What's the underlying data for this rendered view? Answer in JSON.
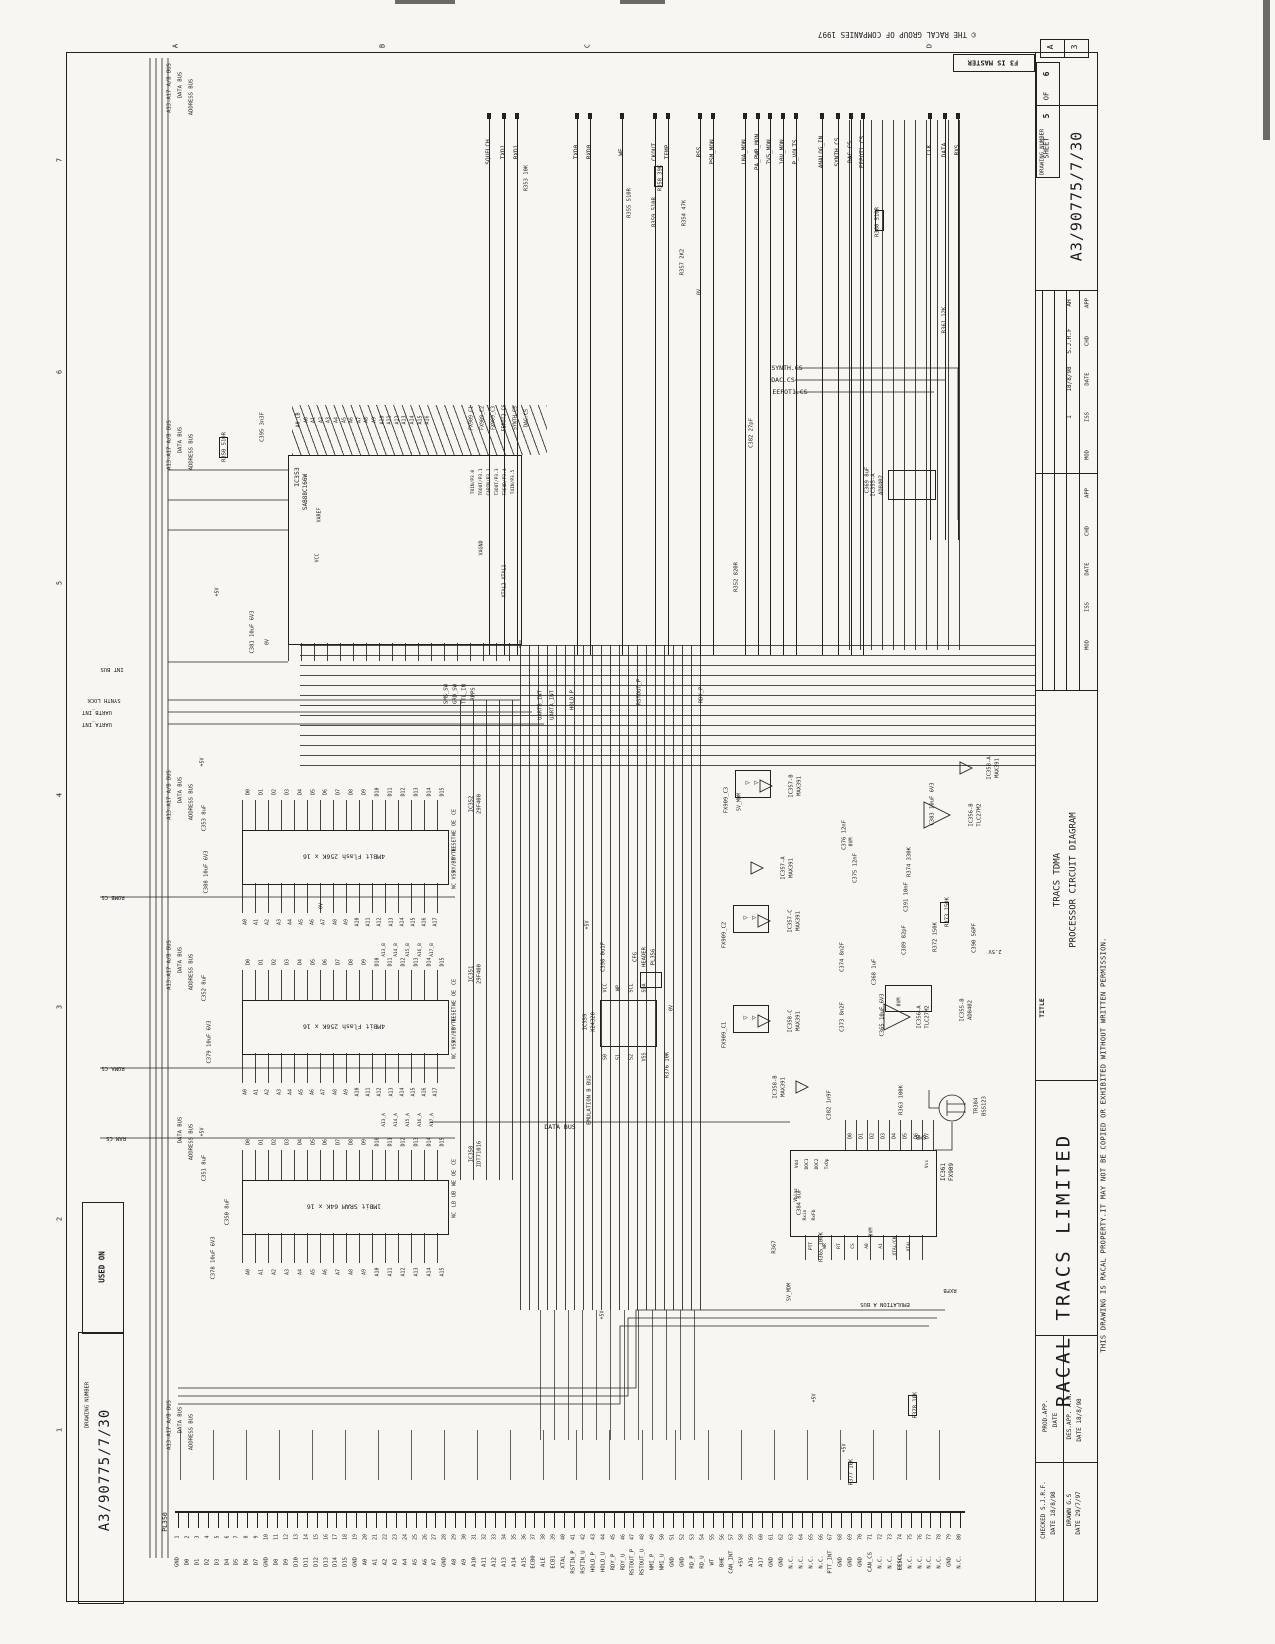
{
  "sheet": {
    "copyright": "© THE RACAL GROUP OF COMPANIES 1997",
    "master_note": "F3 IS MASTER",
    "size_a": "A",
    "size_3": "3",
    "sheet_label": "SHEET",
    "sheet_no": "5",
    "of_label": "OF",
    "sheet_total": "6",
    "drawing_number_label": "DRAWING NUMBER",
    "drawing_number": "A3/90775/7/30",
    "used_on": "USED ON",
    "title_label": "TITLE",
    "title1": "TRACS TDMA",
    "title2": "PROCESSOR CIRCUIT DIAGRAM",
    "company": "RACAL TRACS LIMITED",
    "property_note": "THIS DRAWING IS RACAL PROPERTY.IT MAY NOT BE COPIED OR EXHIBITED WITHOUT WRITTEN PERMISSION.",
    "approvals": {
      "prod": "PROD.APP.",
      "prod_date": "DATE",
      "des": "DES.APP. A.H.",
      "des_date": "DATE  18/8/98",
      "checked": "CHECKED S.J.R.F.",
      "checked_date": "DATE  18/8/98",
      "drawn": "DRAWN G.S",
      "drawn_date": "DATE  29/7/97"
    },
    "revision": {
      "headers": [
        "MOD",
        "ISS",
        "DATE",
        "CHD",
        "APP"
      ],
      "values": {
        "mod": "",
        "iss": "1",
        "date": "18/8/98",
        "chd": "S.J.R.F",
        "app": "AH"
      }
    },
    "zones": {
      "numbers": [
        "7",
        "6",
        "5",
        "4",
        "3",
        "2",
        "1"
      ],
      "letters": [
        "A",
        "B",
        "C",
        "D"
      ]
    }
  },
  "buses": {
    "names": [
      "A13-A17 A/B BUS",
      "DATA BUS",
      "ADDRESS BUS"
    ]
  },
  "signals": {
    "top": [
      "SQUELCH",
      "TXD1",
      "RXD1",
      "TXD0",
      "RXD0",
      "WE",
      "CKOUT",
      "TEMP",
      "RSS",
      "PSM_MON",
      "LNA_MON",
      "PA_PWR_MON",
      "7V5_MON",
      "10V_MON",
      "P_VOLTS",
      "ANALOG_IN",
      "SYNTH.CS",
      "DAC.CS",
      "EEPOT1.CS"
    ],
    "top2": [
      "CLK",
      "DATA",
      "RXS"
    ]
  },
  "cpu": {
    "ref": "IC353",
    "part": "SAB88C166W",
    "top_pins": [
      "A0_LB",
      "A0",
      "A1",
      "A2",
      "A3",
      "A4",
      "A5",
      "A6",
      "A7",
      "A8",
      "A9",
      "A10",
      "A11",
      "A12",
      "A13",
      "A14",
      "A15",
      "A16"
    ],
    "right_pins": [
      "FX909_C1",
      "FX909_C2",
      "FX909_C3",
      "EEPOT2.CS",
      "SYNTH.CS",
      "DAC.CS"
    ],
    "port_labels": [
      "T8IN/P3.0",
      "T6OUT/P3.1",
      "CAPIN/P3.2",
      "T3OUT/P3.3",
      "T3EUD/P3.4",
      "T4IN/P3.5"
    ],
    "inner": [
      "VAREF",
      "VCC",
      "VAGND",
      "XTAL1",
      "XTAL2"
    ]
  },
  "memory": [
    {
      "ref": "IC352",
      "part": "29F400",
      "desc": "4MBit Flash 256K x 16"
    },
    {
      "ref": "IC351",
      "part": "29F400",
      "desc": "4MBit Flash 256K x 16"
    },
    {
      "ref": "IC358",
      "part": "IDT71016",
      "desc": "1MBit SRAM 64K x 16"
    }
  ],
  "mem_pins": {
    "d": [
      "D0",
      "D1",
      "D2",
      "D3",
      "D4",
      "D5",
      "D6",
      "D7",
      "D8",
      "D9",
      "D10",
      "D11",
      "D12",
      "D13",
      "D14",
      "D15"
    ],
    "a18": [
      "A0",
      "A1",
      "A2",
      "A3",
      "A4",
      "A5",
      "A6",
      "A7",
      "A8",
      "A9",
      "A10",
      "A11",
      "A12",
      "A13",
      "A14",
      "A15",
      "A16",
      "A17"
    ],
    "a16": [
      "A0",
      "A1",
      "A2",
      "A3",
      "A4",
      "A5",
      "A6",
      "A7",
      "A8",
      "A9",
      "A10",
      "A11",
      "A12",
      "A13",
      "A14",
      "A15"
    ],
    "flash_ctrl": [
      "CE",
      "OE",
      "WE",
      "RESET",
      "BYTE",
      "RY/BY",
      "VSS",
      "NC"
    ],
    "sram_ctrl": [
      "CE",
      "OE",
      "WE",
      "UB",
      "LB",
      "NC"
    ],
    "ab_b": [
      "A13_B",
      "A14_B",
      "A15_B",
      "A16_B",
      "A17_B"
    ],
    "ab_a": [
      "A13_A",
      "A14_A",
      "A15_A",
      "A16_A",
      "A17_A"
    ]
  },
  "eeprom": {
    "ref": "IC359",
    "part": "X24320",
    "pins_top": [
      "VCC",
      "WP",
      "SCL",
      "SDA"
    ],
    "pins_bot": [
      "S0",
      "S1",
      "S2",
      "VSS"
    ],
    "header": [
      "CFG",
      "HEADER",
      "PL356"
    ]
  },
  "modem": {
    "ref": "IC361",
    "part": "FX909",
    "top": [
      "D0",
      "D1",
      "D2",
      "D3",
      "D4",
      "D5",
      "D6",
      "D7"
    ],
    "left_top": [
      "Vdd",
      "DOC1",
      "DOC2",
      "TxOp"
    ],
    "left_low": [
      "Vbias",
      "Rxin",
      "RxFb"
    ],
    "bottom": [
      "PTT",
      "WR",
      "RT",
      "CS",
      "A0",
      "A1",
      "XTAL/CK",
      "XTAL"
    ],
    "right": [
      "Vss"
    ]
  },
  "analog": {
    "filters": [
      "FX909_C3",
      "FX909_C2",
      "FX909_C1"
    ],
    "opamps": [
      {
        "ref": "IC357-B",
        "part": "MAX391"
      },
      {
        "ref": "IC357-A",
        "part": "MAX391"
      },
      {
        "ref": "IC357-C",
        "part": "MAX391"
      },
      {
        "ref": "IC358-C",
        "part": "MAX391"
      },
      {
        "ref": "IC358-A",
        "part": "MAX391"
      },
      {
        "ref": "IC358-B",
        "part": "MAX391"
      },
      {
        "ref": "IC356-B",
        "part": "TLC27M2"
      },
      {
        "ref": "IC356-A",
        "part": "TLC27M2"
      },
      {
        "ref": "IC355-A",
        "part": "AD8402"
      },
      {
        "ref": "IC355-B",
        "part": "AD8402"
      }
    ]
  },
  "transistor": {
    "ref": "TR384",
    "part": "BSS123",
    "pkg": "SMB"
  },
  "components": [
    "R350 510R",
    "C395 3n3F",
    "R353 10K",
    "R355 510R",
    "R358 39K",
    "R359 510R",
    "R354 47K",
    "R360 510R",
    "R357 2K2",
    "R361 12K",
    "C382 27pF",
    "R352 820R",
    "C369 8uF",
    "C381 10uF 6V3",
    "C353 8uF",
    "C388 10uF 6V3",
    "C352 8uF",
    "C379 10uF 6V3",
    "C351 8uF",
    "C350 8uF",
    "C378 10uF 6V3",
    "C376 12nF",
    "C375 12nF",
    "C374 8n2F",
    "C373 8n2F",
    "R374 330K",
    "C391 10nF",
    "R373 150K",
    "R372 150K",
    "C389 82pF",
    "C390 56PF",
    "C383 10uF 6V3",
    "C368 1uF",
    "C365 10uF 6V3",
    "C384 8uF",
    "C382 1n9F",
    "R363 100K",
    "R365 100K",
    "R367",
    "R377 10K",
    "R378 10K",
    "C398 0u1F",
    "R376 10K"
  ],
  "volts": [
    "+5V",
    "0V",
    "0VM",
    "5V_MDM"
  ],
  "misc_labels": [
    "INT BUS",
    "SYNTH LOCK",
    "UARTB_INT",
    "UARTA_INT",
    "ROMB CS",
    "ROMA CS",
    "RAM CS",
    "RXFB",
    "EMULATION A BUS",
    "EMULATION B BUS",
    "DATA BUS",
    "SYNTH.CS",
    "DAC.CS",
    "EEPOT1.CS",
    "UARTB_INT",
    "UARTA_INT",
    "HOLD_P",
    "RSTOUT_P",
    "RDY_P",
    "SMS_SW",
    "GRD_SW",
    "TTL_IN",
    "RPPS",
    "2.5V"
  ],
  "pl350": {
    "ref": "PL350",
    "pins": [
      "GND",
      "D0",
      "D1",
      "D2",
      "D3",
      "D4",
      "D5",
      "D6",
      "D7",
      "GND",
      "D8",
      "D9",
      "D10",
      "D11",
      "D12",
      "D13",
      "D14",
      "D15",
      "GND",
      "A0",
      "A1",
      "A2",
      "A3",
      "A4",
      "A5",
      "A6",
      "A7",
      "GND",
      "A8",
      "A9",
      "A10",
      "A11",
      "A12",
      "A13",
      "A14",
      "A15",
      "ECB0",
      "ALE",
      "ECB1",
      "XTAL",
      "RSTIN_P",
      "RSTIN_U",
      "HOLD_P",
      "HOLD_U",
      "RDY_P",
      "RDY_U",
      "RSTOUT_P",
      "RSTOUT_U",
      "NMI_P",
      "NMI_U",
      "GND",
      "GND",
      "RD_P",
      "RD_U",
      "WT",
      "BHE",
      "CAN_INT",
      "+5V",
      "A16",
      "A17",
      "GND",
      "GND",
      "N.C.",
      "N.C.",
      "N.C.",
      "N.C.",
      "PTT_INT",
      "GND",
      "GND",
      "GND",
      "CAN_CS",
      "N.C.",
      "N.C.",
      "EESCL",
      "N.C.",
      "N.C.",
      "N.C.",
      "N.C.",
      "GND",
      "N.C."
    ]
  }
}
